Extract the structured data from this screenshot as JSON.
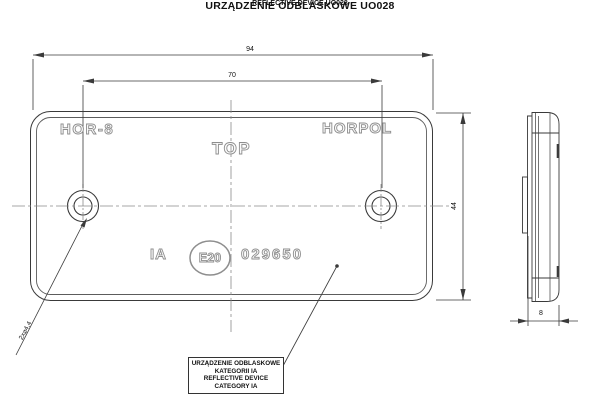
{
  "drawing": {
    "title_pl": "URZĄDZENIE ODBLASKOWE UO028",
    "title_en": "REFLECTIVE DEVICE UO028"
  },
  "front_view": {
    "marking_model": "HOR-8",
    "marking_brand": "HORPOL",
    "marking_top": "TOP",
    "marking_category": "IA",
    "marking_homologation": "E20",
    "marking_number": "029650"
  },
  "dimensions": {
    "overall_width": "94",
    "hole_spacing": "70",
    "overall_height": "44",
    "thickness": "8",
    "hole_callout": "2x⌀4,4"
  },
  "note": {
    "line1": "URZĄDZENIE ODBLASKOWE",
    "line2": "KATEGORII IA",
    "line3": "REFLECTIVE DEVICE",
    "line4": "CATEGORY IA"
  },
  "colors": {
    "line": "#3a3a3a",
    "centerline": "#8a8a8a",
    "marking": "#8e8e8e",
    "background": "#ffffff"
  }
}
